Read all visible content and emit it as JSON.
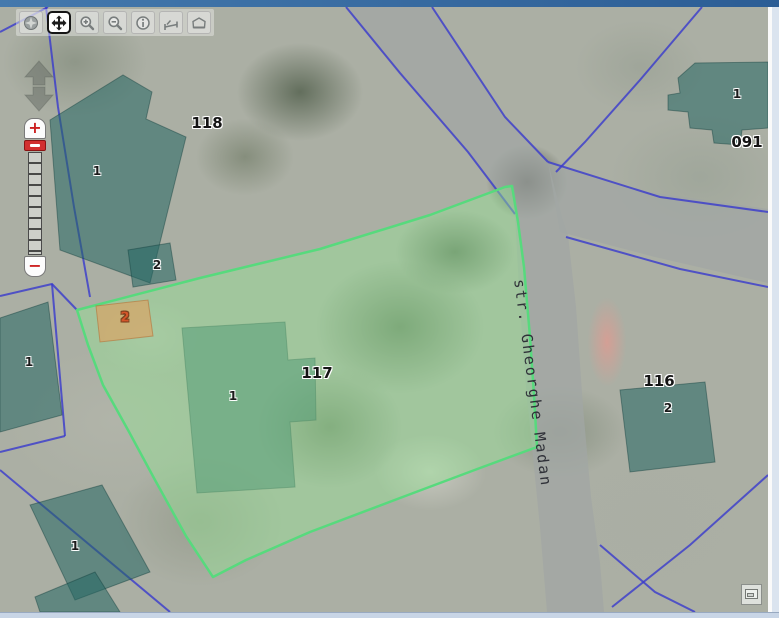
{
  "window": {
    "top_bar_color": "#37699f",
    "bottom_bar_color": "#c8d5e6"
  },
  "toolbar": {
    "active_tool": "pan",
    "buttons": [
      {
        "name": "zoom-max-extent",
        "icon": "globe-icon",
        "active": false
      },
      {
        "name": "pan",
        "icon": "pan-arrows-icon",
        "active": true
      },
      {
        "name": "zoom-in",
        "icon": "magnifier-plus-icon",
        "active": false
      },
      {
        "name": "zoom-out",
        "icon": "magnifier-minus-icon",
        "active": false
      },
      {
        "name": "identify",
        "icon": "info-icon",
        "active": false
      },
      {
        "name": "measure-distance",
        "icon": "measure-line-icon",
        "active": false
      },
      {
        "name": "measure-area",
        "icon": "measure-area-icon",
        "active": false
      }
    ]
  },
  "pan_control": {
    "icons": [
      "pan-up-icon",
      "pan-down-icon"
    ]
  },
  "zoom_control": {
    "zoom_in": "+",
    "zoom_out": "−"
  },
  "map": {
    "street_label": "str. Gheorghe Madan",
    "selected_parcel": "117",
    "parcel_labels": [
      {
        "text": "118"
      },
      {
        "text": "091"
      },
      {
        "text": "117"
      },
      {
        "text": "116"
      }
    ],
    "building_labels": [
      {
        "text": "1"
      },
      {
        "text": "2"
      },
      {
        "text": "1"
      },
      {
        "text": "1"
      },
      {
        "text": "1"
      },
      {
        "text": "1"
      },
      {
        "text": "2"
      }
    ],
    "selected_building_label": {
      "text": "2"
    },
    "colors": {
      "parcel_highlight_fill": "#94e294",
      "parcel_highlight_stroke": "#57da7d",
      "selection_fill": "#e29e5c",
      "selection_label": "#d4562a",
      "boundary_line": "#3a3ccc",
      "building_fill": "#246663",
      "road_fill": "#a2a6a4"
    }
  },
  "overview_control": {
    "icon": "overview-map-icon"
  }
}
